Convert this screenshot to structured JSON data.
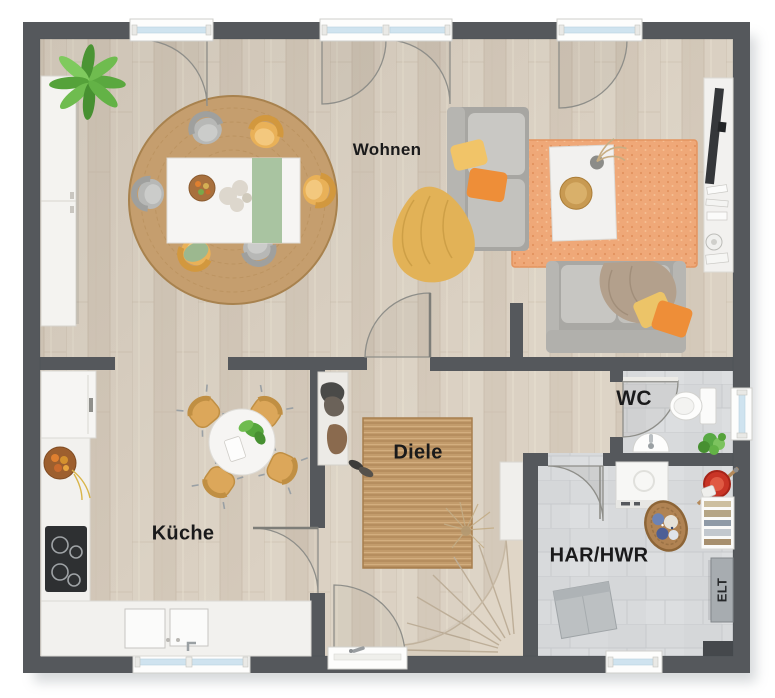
{
  "plan": {
    "type": "floor-plan",
    "language": "de",
    "rooms": [
      {
        "id": "wohnen",
        "label": "Wohnen"
      },
      {
        "id": "kueche",
        "label": "Küche"
      },
      {
        "id": "diele",
        "label": "Diele"
      },
      {
        "id": "wc",
        "label": "WC"
      },
      {
        "id": "har-hwr",
        "label": "HAR/HWR"
      },
      {
        "id": "elt",
        "label": "ELT"
      }
    ],
    "colors": {
      "wall": "#55585c",
      "wood_floor": "#d9cfc1",
      "tile_floor": "#d8dadc",
      "jute_rug": "#c29b6b",
      "orange_rug": "#efa878",
      "sofa_gray": "#a9a8a4",
      "accent_yellow": "#eab158",
      "accent_orange": "#ee8e38",
      "plant_green": "#5aa83f",
      "window_glass": "#cfe3ef",
      "label_text": "#1a1a1b"
    },
    "furniture": [
      "tall-cabinet",
      "palm-plant",
      "round-jute-rug",
      "dining-table",
      "dining-chairs",
      "chaise-sofa",
      "throw-blanket",
      "orange-rug",
      "coffee-table",
      "sofa",
      "tv-lowboard",
      "fridge",
      "kitchen-counter",
      "cooktop",
      "kitchen-sink",
      "kitchen-table",
      "kitchen-chairs",
      "coat-rack",
      "shoes",
      "hallway-rug",
      "dried-plant",
      "winder-staircase",
      "entrance-door",
      "toilet",
      "wc-sink",
      "wc-plant",
      "washing-machine",
      "laundry-basket",
      "mop-bucket",
      "utility-shelf",
      "storage-box",
      "electrical-panel"
    ]
  }
}
